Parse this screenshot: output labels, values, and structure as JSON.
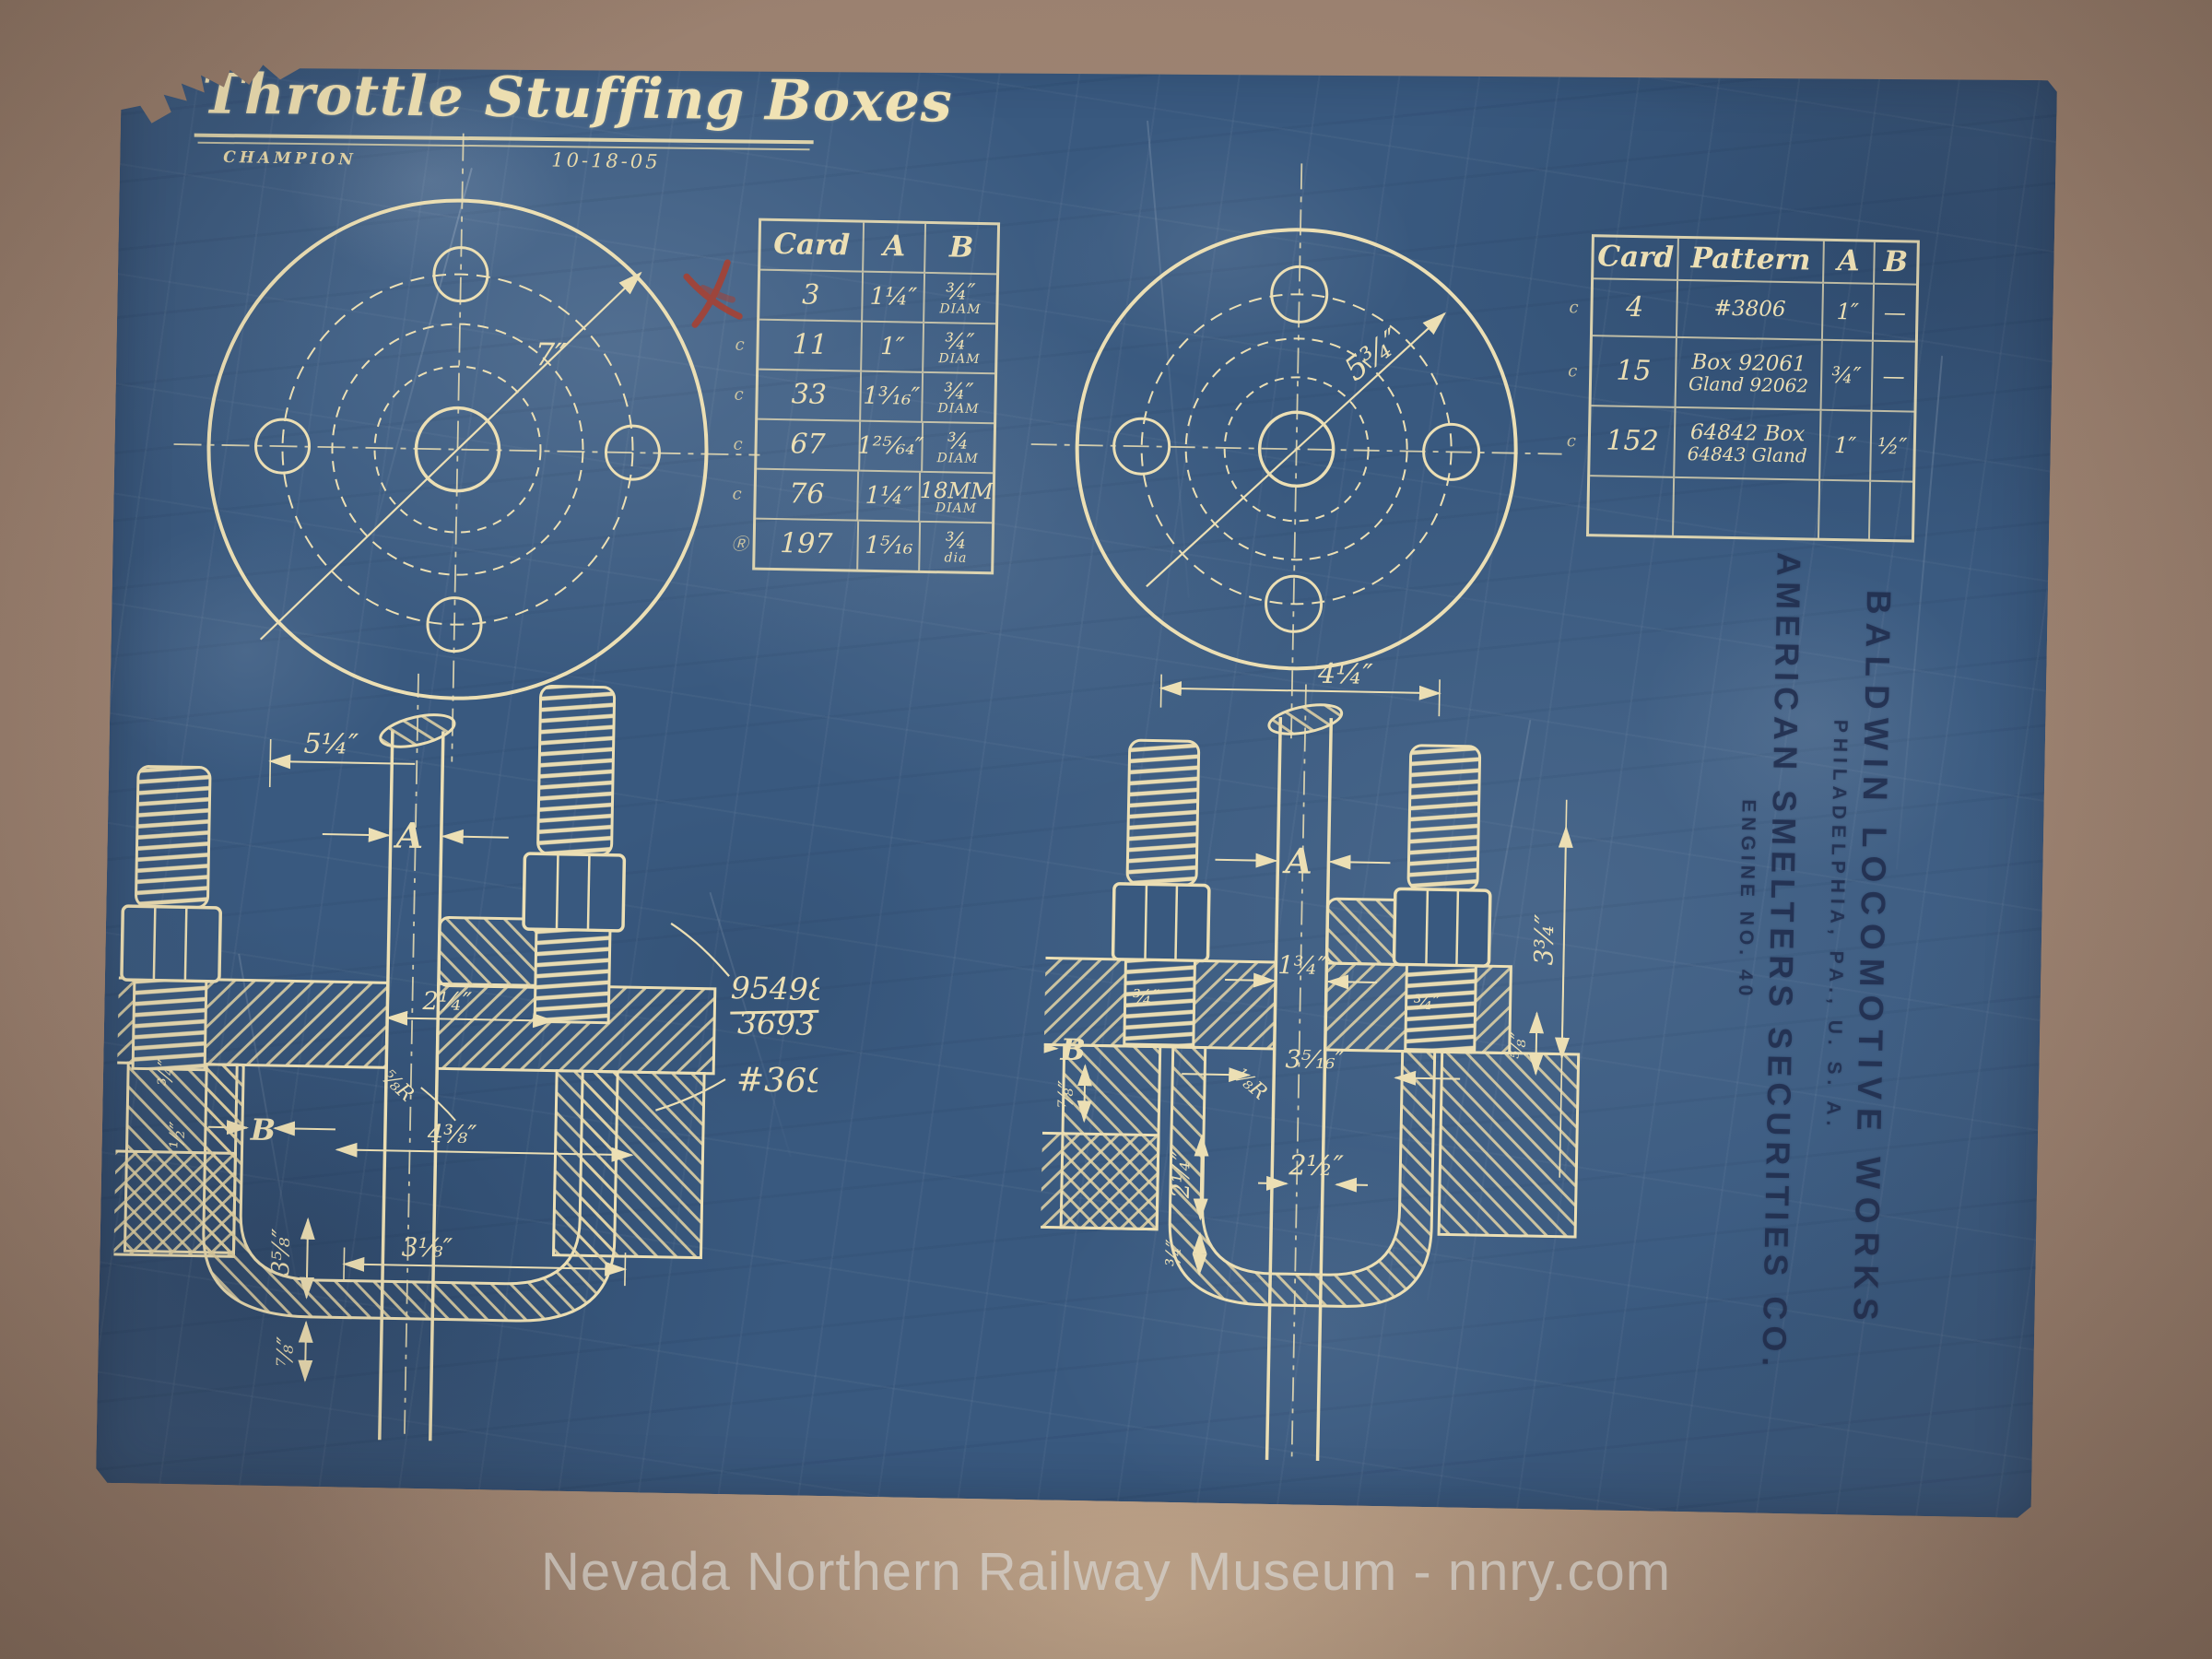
{
  "bp": {
    "title": "Throttle Stuffing Boxes",
    "maker": "CHAMPION",
    "date": "10-18-05",
    "flange_left_radius": "7″",
    "flange_right_radius": "5¾″",
    "lt": {
      "h": [
        "Card",
        "A",
        "B"
      ],
      "r": [
        {
          "p": "",
          "c": "3",
          "a": "1¼″",
          "b": "¾″",
          "s": "DIAM"
        },
        {
          "p": "c",
          "c": "11",
          "a": "1″",
          "b": "¾″",
          "s": "DIAM"
        },
        {
          "p": "c",
          "c": "33",
          "a": "1³⁄₁₆″",
          "b": "¾″",
          "s": "DIAM"
        },
        {
          "p": "c",
          "c": "67",
          "a": "1²⁵⁄₆₄″",
          "b": "¾",
          "s": "DIAM"
        },
        {
          "p": "c",
          "c": "76",
          "a": "1¼″",
          "b": "18MM",
          "s": "DIAM"
        },
        {
          "p": "Ⓡ",
          "c": "197",
          "a": "1⁵⁄₁₆",
          "b": "¾",
          "s": "dia"
        }
      ]
    },
    "rt": {
      "h": [
        "Card",
        "Pattern",
        "A",
        "B"
      ],
      "r": [
        {
          "p": "c",
          "c": "4",
          "p1": "#3806",
          "p2": "",
          "a": "1″",
          "b": "—"
        },
        {
          "p": "c",
          "c": "15",
          "p1": "Box 92061",
          "p2": "Gland 92062",
          "a": "¾″",
          "b": "—"
        },
        {
          "p": "c",
          "c": "152",
          "p1": "64842 Box",
          "p2": "64843 Gland",
          "a": "1″",
          "b": "½″"
        }
      ]
    },
    "ls": {
      "top": "5¼″",
      "a": "A",
      "d1": "2¼″",
      "b": "B",
      "d2": "4⅜″",
      "r": "⅝R",
      "f1": "¾″",
      "f2": "½″",
      "bot": "3⅛″",
      "v1": "3⅝″",
      "v2": "⅞″",
      "pn1": "95498",
      "pn2": "3693",
      "pn3": "#3693"
    },
    "rs": {
      "top": "4¼″",
      "a": "A",
      "d1": "1¾″",
      "n1": "¾″",
      "n2": "¾″",
      "b": "B",
      "r": "⅛R",
      "d2": "3⁵⁄₁₆″",
      "d3": "2½″",
      "v1": "3¾″",
      "v2": "⅝″",
      "v3": "2¼″",
      "v4": "¾″",
      "v5": "⅞″"
    },
    "stamp": {
      "l1": "BALDWIN LOCOMOTIVE WORKS",
      "l2": "PHILADELPHIA, PA., U. S. A.",
      "l3": "AMERICAN SMELTERS SECURITIES CO.",
      "l4": "ENGINE NO. 40"
    },
    "colors": {
      "paper": "#a98e79",
      "blue": "#39597f",
      "line": "#ecdfb4",
      "stamp": "#2a3a5e",
      "red": "#b23c28"
    }
  },
  "watermark": "Nevada Northern Railway Museum - nnry.com"
}
